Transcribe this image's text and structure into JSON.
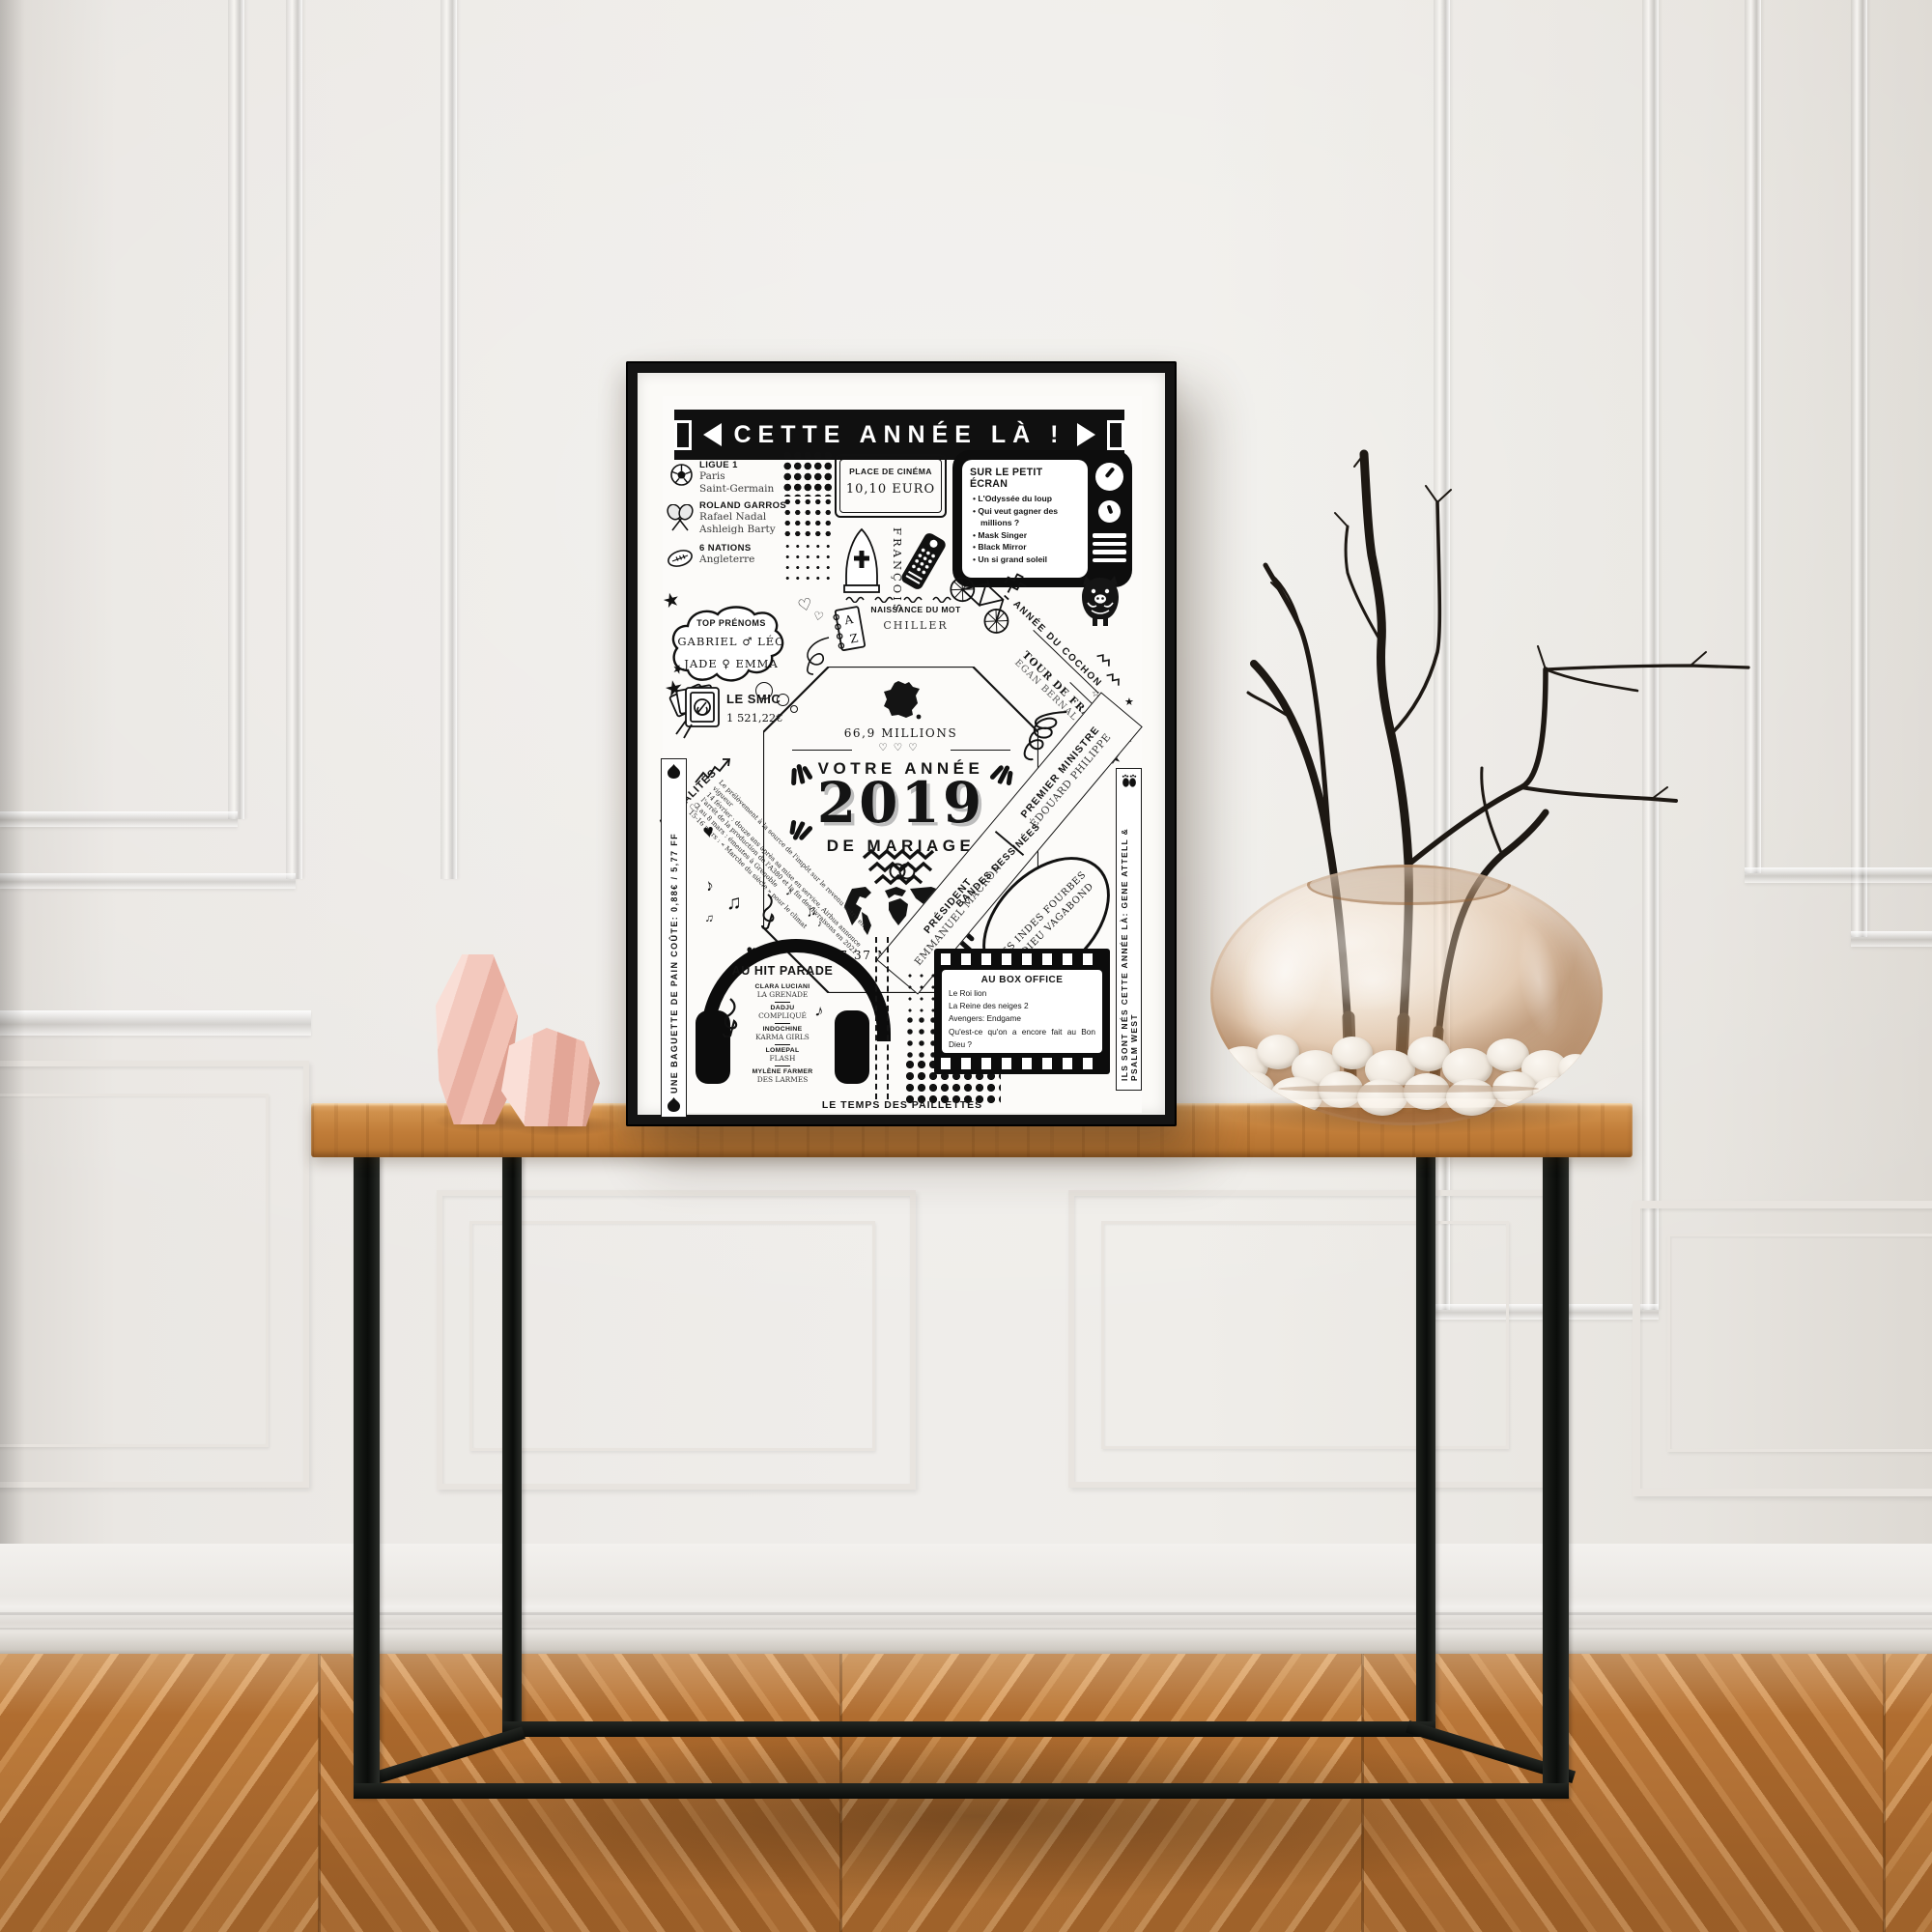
{
  "palette": {
    "wall": "#ece9e5",
    "floor": "#bd7b3b",
    "floor_light": "#d99f63",
    "table_wood": "#c07c38",
    "metal_black": "#101210",
    "frame_black": "#141414",
    "paper": "#fcfbf9",
    "ink": "#141414",
    "pink": "#f3c9be",
    "pink_light": "#f9ded6",
    "pink_dark": "#dfa191",
    "glass_amber": "#d6a06e",
    "pebble_white": "#f1ebe2",
    "branch_black": "#1d1813",
    "shadow_gray": "#bcbcbc"
  },
  "icons": {
    "star": "★",
    "star_outline": "☆",
    "heart": "♥",
    "heart_outline": "♡",
    "note": "♪",
    "notes": "♫",
    "bullet": "•"
  },
  "poster": {
    "header": {
      "title": "CETTE ANNÉE LÀ !"
    },
    "sports": {
      "ligue1": {
        "title": "LIGUE 1",
        "line1": "Paris",
        "line2": "Saint-Germain"
      },
      "roland": {
        "title": "ROLAND GARROS",
        "line1": "Rafael Nadal",
        "line2": "Ashleigh Barty"
      },
      "nations": {
        "title": "6 NATIONS",
        "line1": "Angleterre"
      }
    },
    "cinema": {
      "title": "PLACE DE CINÉMA",
      "price": "10,10  EURO"
    },
    "pope": {
      "name": "FRANÇOIS"
    },
    "tv": {
      "title": "SUR LE PETIT ÉCRAN",
      "items": [
        "L'Odyssée du loup",
        "Qui veut gagner des millions ?",
        "Mask Singer",
        "Black Mirror",
        "Un si grand soleil"
      ]
    },
    "prenoms": {
      "title": "TOP PRÉNOMS",
      "boys": "GABRIEL ♂ LÉO",
      "girls": "JADE ♀ EMMA"
    },
    "mot": {
      "title": "NAISSANCE DU MOT",
      "word": "CHILLER"
    },
    "cochon": {
      "label": "ANNÉE DU COCHON"
    },
    "tour": {
      "title": "TOUR DE FRANCE",
      "name": "EGAN BERNAL"
    },
    "smic": {
      "title": "LE SMIC",
      "value": "1 521,22€"
    },
    "center": {
      "fr": "66,9 MILLIONS",
      "l1": "VOTRE ANNÉE",
      "year": "2019",
      "l2": "DE MARIAGE",
      "world": "7,37 MILLIARDS"
    },
    "actualites": {
      "title": "ACTUALITÉS",
      "lines": [
        "Le prélèvement à la source de l'impôt sur le revenu entre en",
        "vigueur",
        "14 février : douze ans après sa mise en service, Airbus annonce",
        "l'arrêt de la production de l'A380 et la fin des livraisons en 2021",
        "2 au 8 mars : émeutes à Grenoble",
        "15-16 mars : « Marche du siècle » pour le climat"
      ]
    },
    "pm": {
      "title": "PREMIER MINISTRE",
      "name": "ÉDOUARD PHILIPPE"
    },
    "president": {
      "title": "PRÉSIDENT",
      "name": "EMMANUEL MACRON"
    },
    "bd": {
      "title": "BANDES DESSINÉES",
      "item1": "LES INDES FOURBES",
      "item2": "LE DIEU VAGABOND"
    },
    "hit": {
      "title": "AU HIT PARADE",
      "entries": [
        {
          "artist": "CLARA LUCIANI",
          "song": "LA GRENADE"
        },
        {
          "artist": "DADJU",
          "song": "COMPLIQUÉ"
        },
        {
          "artist": "INDOCHINE",
          "song": "KARMA GIRLS"
        },
        {
          "artist": "LOMEPAL",
          "song": "FLASH"
        },
        {
          "artist": "MYLÈNE FARMER",
          "song": "DES LARMES"
        }
      ]
    },
    "box": {
      "title": "AU BOX OFFICE",
      "items": [
        "Le Roi lion",
        "La Reine des neiges 2",
        "Avengers: Endgame",
        "Qu'est-ce qu'on a encore fait au Bon Dieu ?"
      ]
    },
    "left_banner": "UNE BAGUETTE DE PAIN COÛTE: 0,88€ / 5,77 FF",
    "right_banner": "ILS SONT NÉS CETTE ANNÉE LÀ: GENE ATTELL & PSALM WEST",
    "footer": "LE TEMPS DES PAILLETTES"
  }
}
